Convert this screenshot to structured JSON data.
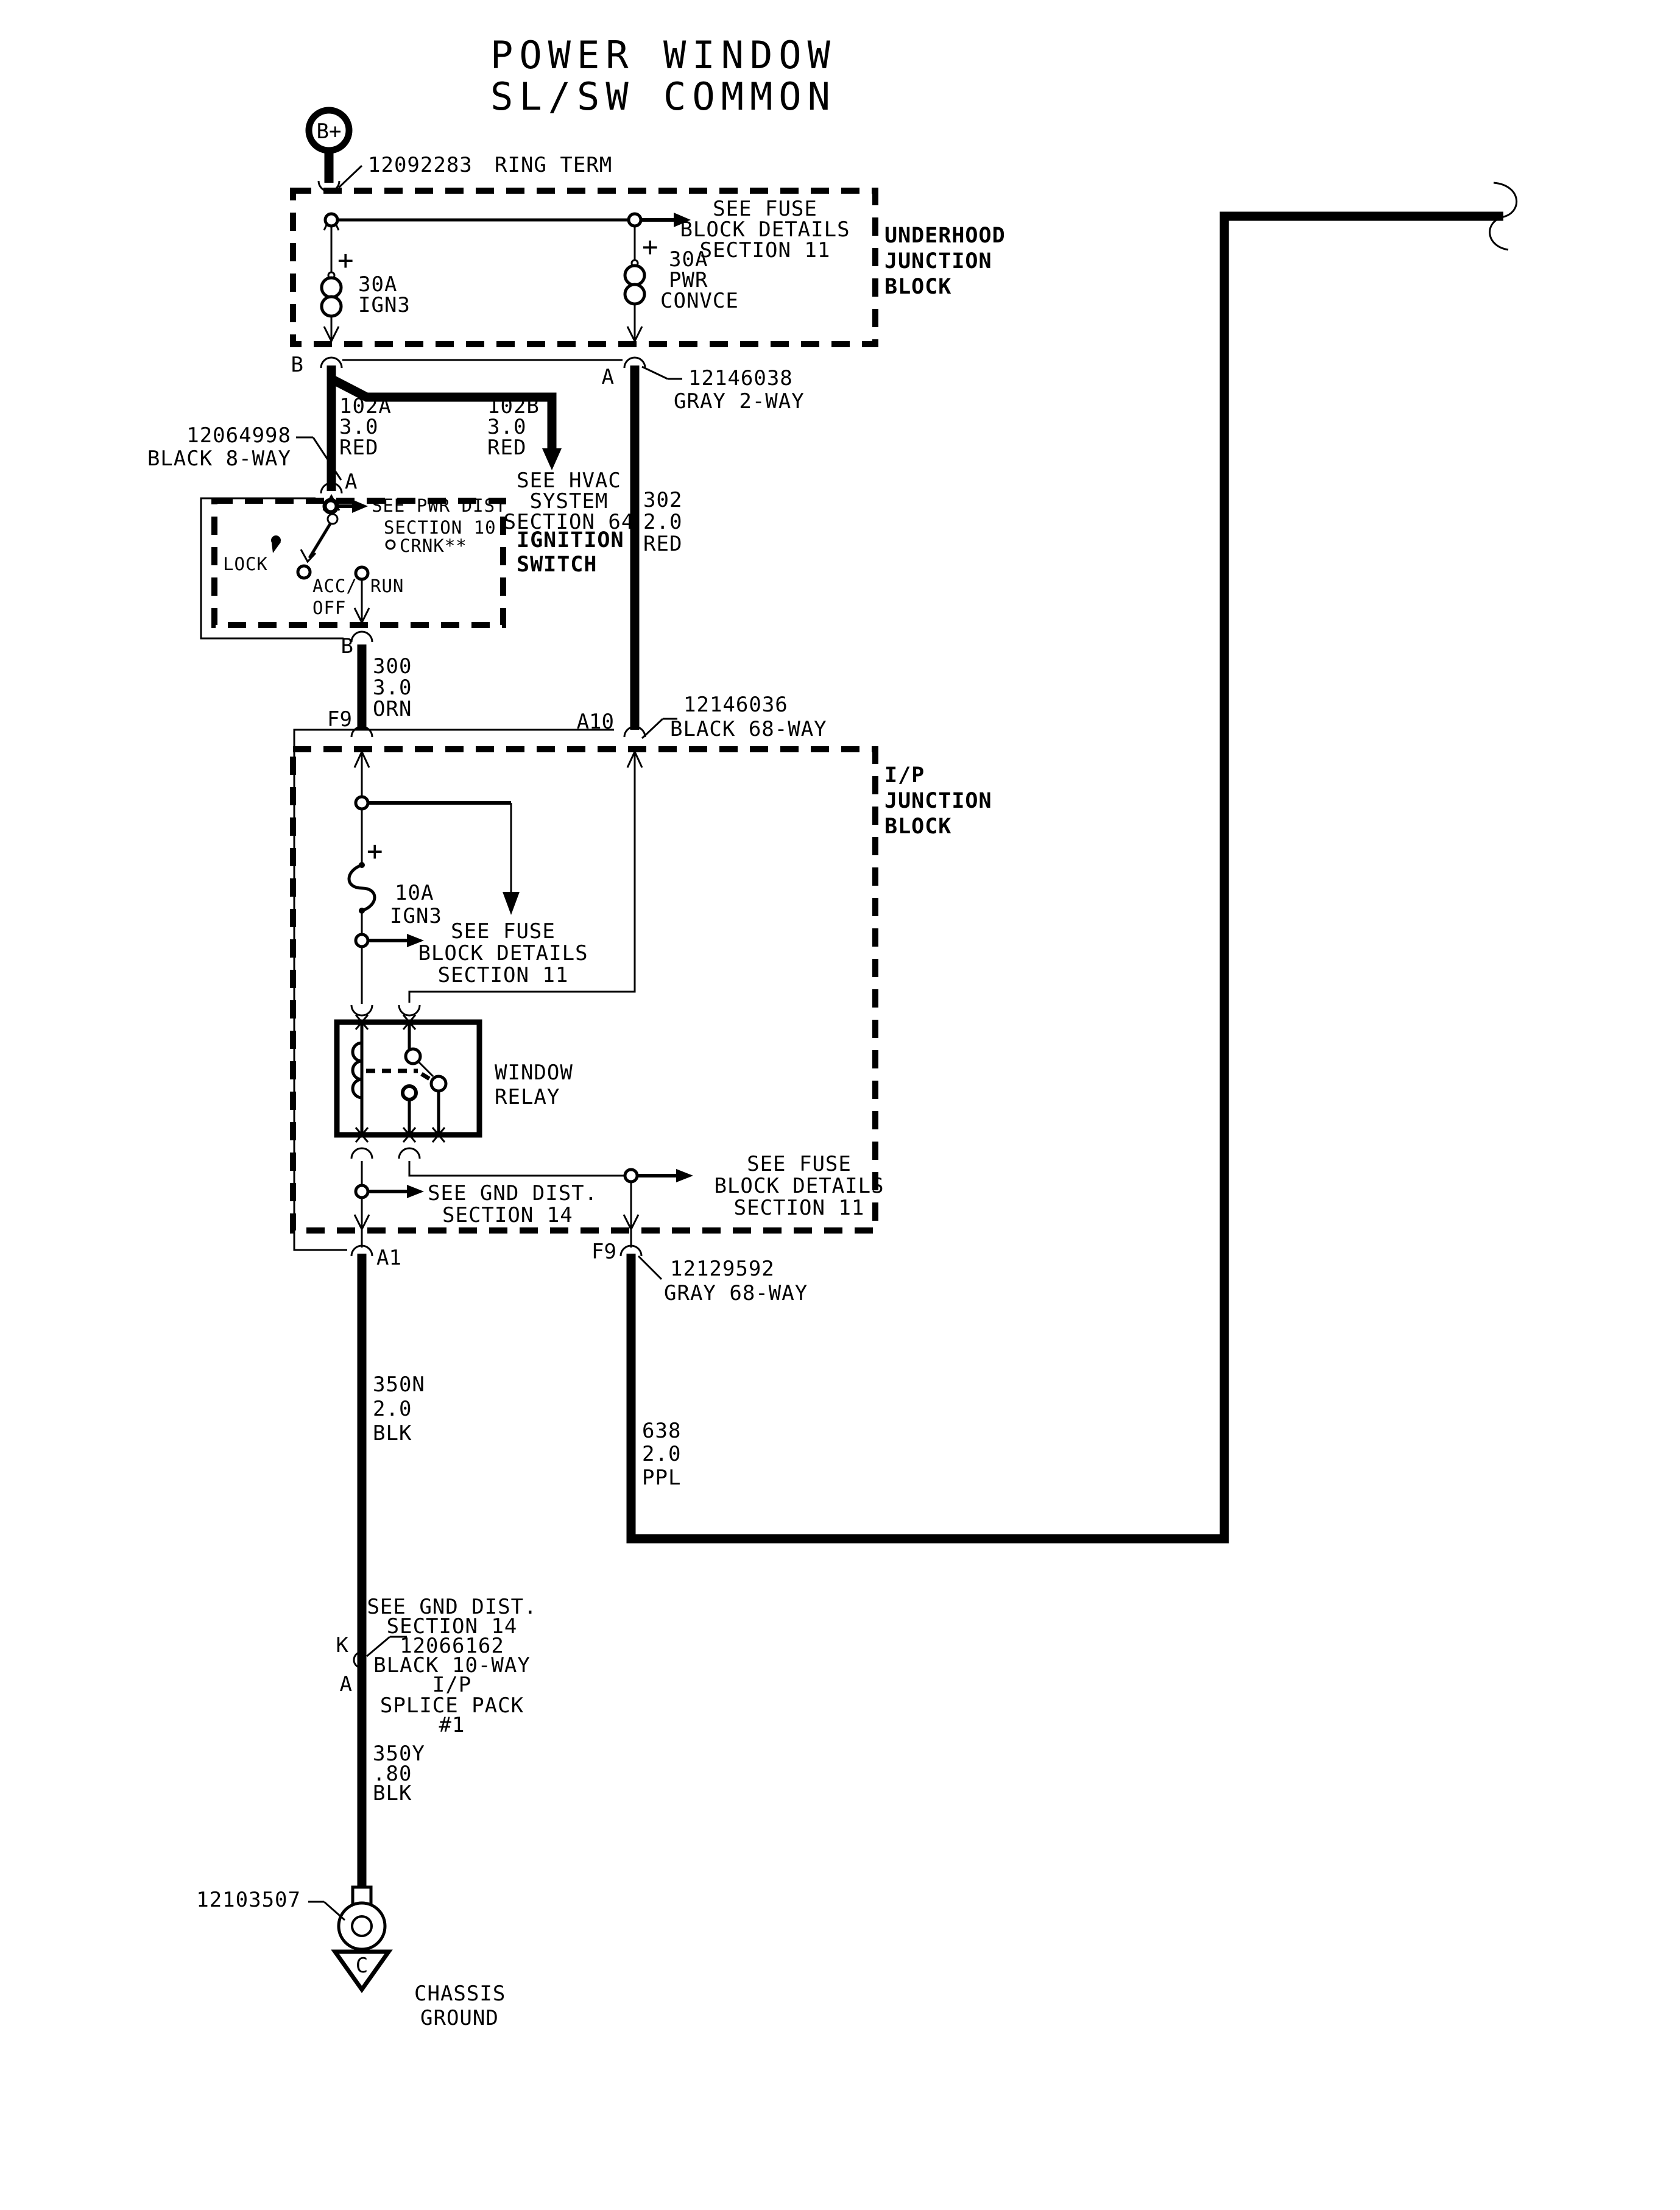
{
  "title": [
    "POWER WINDOW",
    "SL/SW COMMON"
  ],
  "battery": {
    "terminal": "B+",
    "part": "12092283",
    "name": "RING TERM"
  },
  "underhood": {
    "block": [
      "UNDERHOOD",
      "JUNCTION",
      "BLOCK"
    ],
    "see_fuse": [
      "SEE FUSE",
      "BLOCK DETAILS",
      "SECTION 11"
    ],
    "fuse_left": [
      "30A",
      "IGN3"
    ],
    "fuse_right": [
      "30A",
      "PWR",
      "CONVCE"
    ],
    "term_b": "B",
    "term_a": "A",
    "plus": "+"
  },
  "conn_12146038": [
    "12146038",
    "GRAY 2-WAY"
  ],
  "wire_102a": [
    "102A",
    "3.0",
    "RED"
  ],
  "wire_102b": [
    "102B",
    "3.0",
    "RED"
  ],
  "see_hvac": [
    "SEE HVAC",
    "SYSTEM",
    "SECTION 64"
  ],
  "conn_12064998": [
    "12064998",
    "BLACK 8-WAY"
  ],
  "ignition": {
    "block": [
      "IGNITION",
      "SWITCH"
    ],
    "term_a": "A",
    "term_b": "B",
    "see_pwr": [
      "SEE PWR DIST",
      "SECTION 10"
    ],
    "lock": "LOCK",
    "acc": "ACC/",
    "off": "OFF",
    "run": "RUN",
    "crank": "CRNK**"
  },
  "wire_302": [
    "302",
    "2.0",
    "RED"
  ],
  "wire_300": [
    "300",
    "3.0",
    "ORN"
  ],
  "conn_12146036": [
    "12146036",
    "BLACK 68-WAY"
  ],
  "ip": {
    "block": [
      "I/P",
      "JUNCTION",
      "BLOCK"
    ],
    "term_f9_top": "F9",
    "term_a10": "A10",
    "fuse": [
      "10A",
      "IGN3"
    ],
    "plus": "+",
    "see_fuse_mid": [
      "SEE FUSE",
      "BLOCK DETAILS",
      "SECTION 11"
    ],
    "relay": [
      "WINDOW",
      "RELAY"
    ],
    "see_gnd": [
      "SEE GND DIST.",
      "SECTION 14"
    ],
    "see_fuse_bot": [
      "SEE FUSE",
      "BLOCK DETAILS",
      "SECTION 11"
    ],
    "term_a1": "A1",
    "term_f9_bot": "F9"
  },
  "conn_12129592": [
    "12129592",
    "GRAY 68-WAY"
  ],
  "wire_350n": [
    "350N",
    "2.0",
    "BLK"
  ],
  "wire_638": [
    "638",
    "2.0",
    "PPL"
  ],
  "splice": {
    "lines": [
      "SEE GND DIST.",
      "SECTION 14",
      "12066162",
      "BLACK 10-WAY",
      "I/P",
      "SPLICE PACK",
      "#1"
    ],
    "term_k": "K",
    "term_a": "A"
  },
  "wire_350y": [
    "350Y",
    ".80",
    "BLK"
  ],
  "ground": {
    "part": "12103507",
    "terminal": "C",
    "label": [
      "CHASSIS",
      "GROUND"
    ]
  },
  "colors": {
    "ink": "#000000",
    "paper": "#ffffff"
  }
}
